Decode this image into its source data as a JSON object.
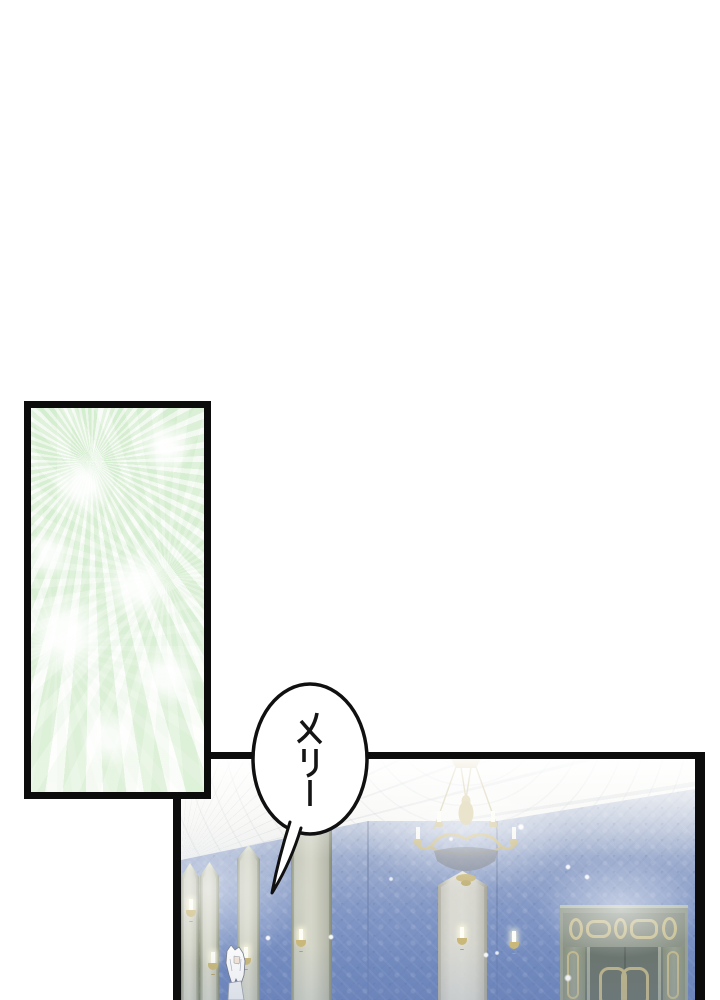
{
  "page": {
    "width_px": 720,
    "height_px": 1000,
    "background": "#ffffff"
  },
  "dialogue": {
    "bubble_text": "メリー"
  },
  "panels": {
    "fireworks_flash": {
      "label": "fireworks-flash-panel",
      "border_color": "#0c0c0c",
      "glow_green": "#dcefd6"
    },
    "ballroom": {
      "label": "ballroom-interior-panel",
      "border_color": "#0c0c0c",
      "wall_blue_top": "#c6cedf",
      "wall_blue_bottom": "#6b84bb",
      "ceiling_white": "#f6f6f3",
      "column_stone": "#c2c5b4",
      "chandelier_gold": "#ccbb80",
      "door_green_gray": "#6e7871",
      "door_trim_gold": "#c6bd8f",
      "character_hair_white": "#fbfbfb",
      "sparkle_white": "#ffffff"
    }
  }
}
